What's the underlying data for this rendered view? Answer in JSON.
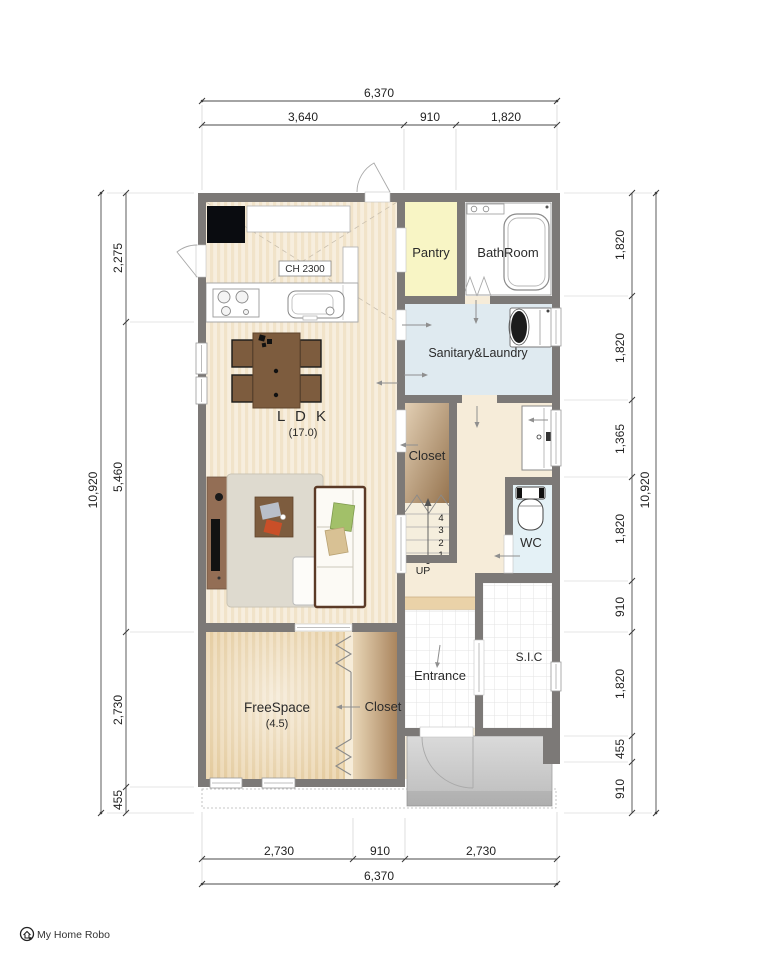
{
  "logo": {
    "text": "My Home Robo"
  },
  "dimensions": {
    "top": {
      "overall": "6,370",
      "segments": [
        "3,640",
        "910",
        "1,820"
      ]
    },
    "bottom": {
      "overall": "6,370",
      "segments": [
        "2,730",
        "910",
        "2,730"
      ]
    },
    "left": {
      "overall": "10,920",
      "segments": [
        "2,275",
        "5,460",
        "2,730",
        "455"
      ]
    },
    "right": {
      "overall": "10,920",
      "segments": [
        "1,820",
        "1,820",
        "1,365",
        "1,820",
        "910",
        "1,820",
        "455",
        "910"
      ]
    }
  },
  "rooms": {
    "ldk": {
      "label": "L D K",
      "area": "(17.0)"
    },
    "pantry": {
      "label": "Pantry"
    },
    "bathroom": {
      "label": "BathRoom"
    },
    "sanitary": {
      "label": "Sanitary&Laundry"
    },
    "closet_mid": {
      "label": "Closet"
    },
    "wc": {
      "label": "WC"
    },
    "entrance": {
      "label": "Entrance"
    },
    "sic": {
      "label": "S.I.C"
    },
    "freespace": {
      "label": "FreeSpace",
      "area": "(4.5)"
    },
    "closet_bottom": {
      "label": "Closet"
    }
  },
  "annotations": {
    "ceiling_height": "CH 2300",
    "up": "UP",
    "stairs": [
      "4",
      "3",
      "2",
      "1"
    ]
  },
  "colors": {
    "wall": "#7c7977",
    "ldk_floor": "#f6ecd9",
    "pantry_floor": "#f8f5c5",
    "sanitary_floor": "#dfeaf0",
    "wc_floor": "#e4f1f6",
    "freespace_floor": "#edd9b6",
    "closet_gradient_dark": "#96744f",
    "porch": "#cfcfcf",
    "step_strip": "#ead2a8"
  }
}
